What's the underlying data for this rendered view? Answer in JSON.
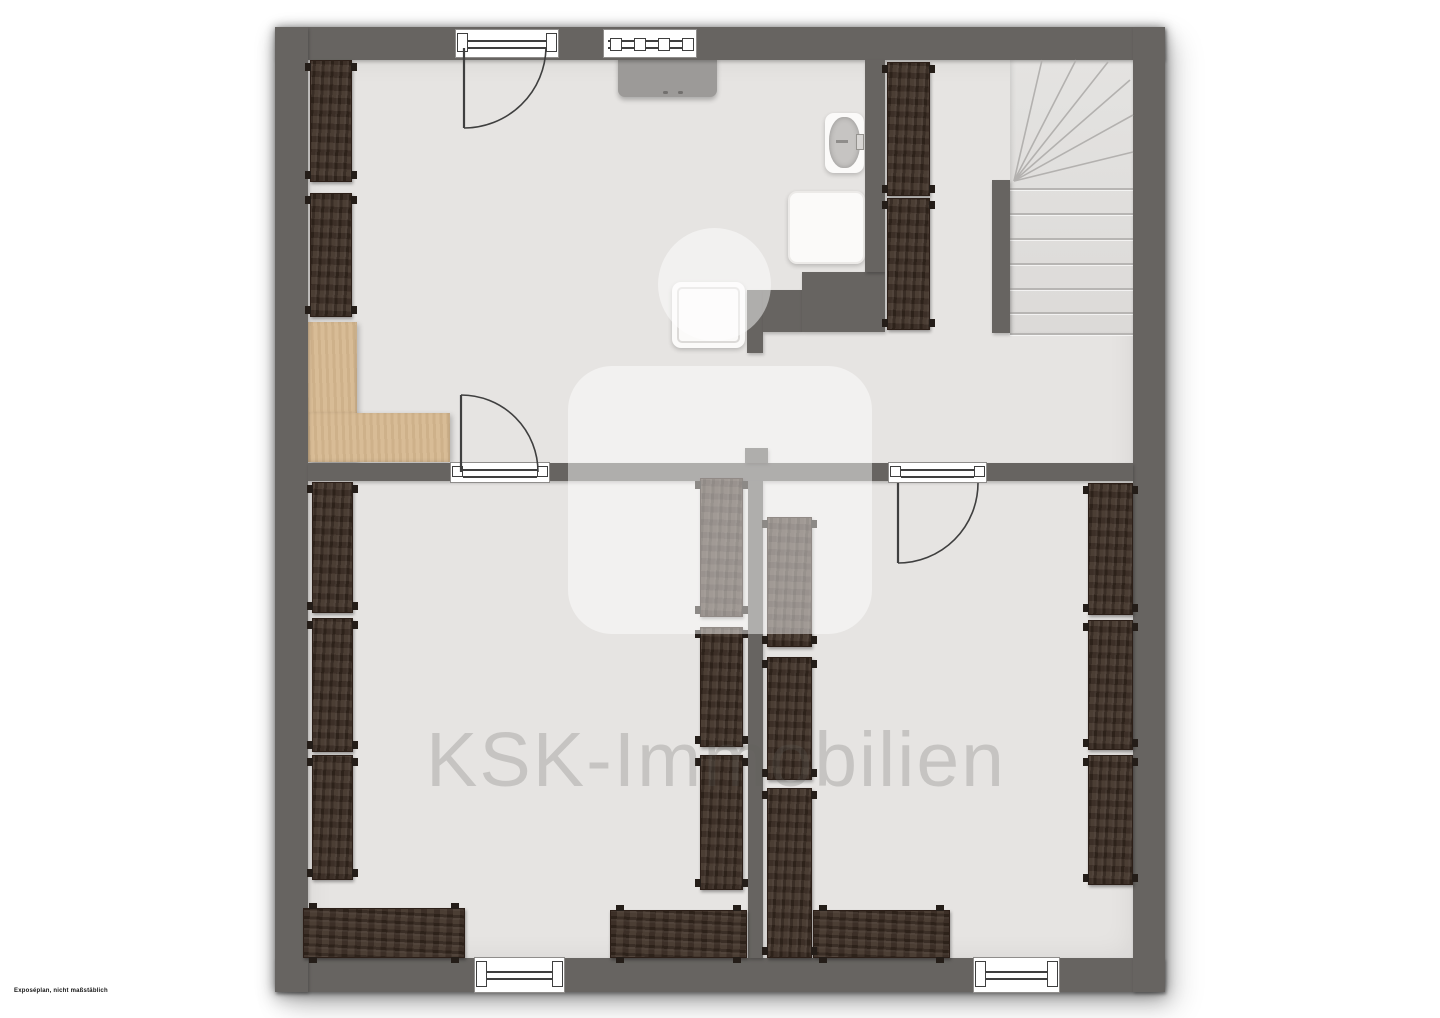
{
  "watermark": {
    "text": "KSK-Immobilien",
    "logo": "sparkasse-emblem"
  },
  "disclaimer": "Exposéplan, nicht maßstäblich",
  "colors": {
    "wall": "#676461",
    "floor": "#e6e4e2",
    "wood": "#3a2b21",
    "tan": "#d6b890",
    "fixture_white": "#fbfaf9",
    "counter": "#9c9a98",
    "stair_floor": "#e3e2e0",
    "arc_stroke": "#3f3f3f",
    "watermark_shape": "rgba(255,255,255,0.48)",
    "watermark_text": "rgba(98,96,94,0.24)"
  },
  "plan": {
    "building": {
      "x": 275,
      "y": 27,
      "w": 890,
      "h": 965
    },
    "floor": {
      "x": 308,
      "y": 60,
      "w": 825,
      "h": 898
    },
    "walls": [
      {
        "name": "wall-top",
        "x": 275,
        "y": 27,
        "w": 890,
        "h": 33
      },
      {
        "name": "wall-bottom",
        "x": 275,
        "y": 958,
        "w": 890,
        "h": 34
      },
      {
        "name": "wall-left",
        "x": 275,
        "y": 27,
        "w": 33,
        "h": 965
      },
      {
        "name": "wall-right",
        "x": 1133,
        "y": 27,
        "w": 32,
        "h": 965
      },
      {
        "name": "wall-middle",
        "x": 308,
        "y": 463,
        "w": 825,
        "h": 18
      },
      {
        "name": "wall-divider-lower",
        "x": 748,
        "y": 481,
        "w": 15,
        "h": 477
      },
      {
        "name": "wall-stub",
        "x": 745,
        "y": 448,
        "w": 23,
        "h": 15
      },
      {
        "name": "wall-bath-left",
        "x": 747,
        "y": 290,
        "w": 16,
        "h": 63
      },
      {
        "name": "wall-bath-mid",
        "x": 763,
        "y": 290,
        "w": 39,
        "h": 42
      },
      {
        "name": "wall-bath-top",
        "x": 802,
        "y": 272,
        "w": 83,
        "h": 60
      },
      {
        "name": "wall-upper-divider",
        "x": 865,
        "y": 60,
        "w": 20,
        "h": 212
      },
      {
        "name": "stair-newel-wall",
        "x": 992,
        "y": 180,
        "w": 18,
        "h": 153
      }
    ],
    "windows": [
      {
        "name": "window-top-left",
        "x": 455,
        "y": 29,
        "w": 104,
        "h": 29,
        "style": "double"
      },
      {
        "name": "window-top-mid",
        "x": 603,
        "y": 29,
        "w": 94,
        "h": 29,
        "style": "panes"
      },
      {
        "name": "window-bottom-left",
        "x": 474,
        "y": 957,
        "w": 91,
        "h": 36,
        "style": "double"
      },
      {
        "name": "window-bottom-right",
        "x": 973,
        "y": 957,
        "w": 87,
        "h": 36,
        "style": "double"
      }
    ],
    "door_sills": [
      {
        "name": "door-sill-left",
        "x": 450,
        "y": 462,
        "w": 100,
        "h": 21,
        "style": "double"
      },
      {
        "name": "door-sill-right",
        "x": 888,
        "y": 462,
        "w": 99,
        "h": 21,
        "style": "double"
      }
    ],
    "doors": [
      {
        "name": "door-top-entry",
        "leaf": "M464,48 L464,128",
        "arc": "M464,128 A82,82 0 0 0 546,48"
      },
      {
        "name": "door-lower-left-room",
        "leaf": "M461,472 L461,395",
        "arc": "M461,395 A77,77 0 0 1 538,472"
      },
      {
        "name": "door-lower-right-room",
        "leaf": "M898,483 L898,563",
        "arc": "M898,563 A80,80 0 0 0 978,483"
      }
    ],
    "wardrobes": [
      {
        "name": "wardrobe-upper-left-1",
        "x": 310,
        "y": 60,
        "w": 42,
        "h": 122,
        "orient": "v"
      },
      {
        "name": "wardrobe-upper-left-2",
        "x": 310,
        "y": 193,
        "w": 42,
        "h": 124,
        "orient": "v"
      },
      {
        "name": "wardrobe-hall-1",
        "x": 887,
        "y": 62,
        "w": 43,
        "h": 134,
        "orient": "v"
      },
      {
        "name": "wardrobe-hall-2",
        "x": 887,
        "y": 198,
        "w": 43,
        "h": 132,
        "orient": "v"
      },
      {
        "name": "wardrobe-lower-left-1",
        "x": 312,
        "y": 482,
        "w": 41,
        "h": 131,
        "orient": "v"
      },
      {
        "name": "wardrobe-lower-left-2",
        "x": 312,
        "y": 618,
        "w": 41,
        "h": 134,
        "orient": "v"
      },
      {
        "name": "wardrobe-lower-left-3",
        "x": 312,
        "y": 755,
        "w": 41,
        "h": 125,
        "orient": "v"
      },
      {
        "name": "wardrobe-center-left-1",
        "x": 700,
        "y": 478,
        "w": 43,
        "h": 139,
        "orient": "v"
      },
      {
        "name": "wardrobe-center-left-2",
        "x": 700,
        "y": 627,
        "w": 43,
        "h": 120,
        "orient": "v"
      },
      {
        "name": "wardrobe-center-left-3",
        "x": 700,
        "y": 755,
        "w": 43,
        "h": 135,
        "orient": "v"
      },
      {
        "name": "wardrobe-center-right-1",
        "x": 767,
        "y": 517,
        "w": 45,
        "h": 130,
        "orient": "v"
      },
      {
        "name": "wardrobe-center-right-2",
        "x": 767,
        "y": 657,
        "w": 45,
        "h": 123,
        "orient": "v"
      },
      {
        "name": "wardrobe-center-right-3",
        "x": 767,
        "y": 788,
        "w": 45,
        "h": 170,
        "orient": "v"
      },
      {
        "name": "wardrobe-lower-right-1",
        "x": 1088,
        "y": 483,
        "w": 45,
        "h": 132,
        "orient": "v"
      },
      {
        "name": "wardrobe-lower-right-2",
        "x": 1088,
        "y": 620,
        "w": 45,
        "h": 130,
        "orient": "v"
      },
      {
        "name": "wardrobe-lower-right-3",
        "x": 1088,
        "y": 755,
        "w": 45,
        "h": 130,
        "orient": "v"
      },
      {
        "name": "wardrobe-bottom-left",
        "x": 303,
        "y": 908,
        "w": 162,
        "h": 50,
        "orient": "h"
      },
      {
        "name": "wardrobe-bottom-mid",
        "x": 610,
        "y": 910,
        "w": 137,
        "h": 48,
        "orient": "h"
      },
      {
        "name": "wardrobe-bottom-right",
        "x": 813,
        "y": 910,
        "w": 137,
        "h": 48,
        "orient": "h"
      }
    ],
    "tan_area": [
      {
        "name": "chimney-block-vertical",
        "x": 308,
        "y": 322,
        "w": 49,
        "h": 140
      },
      {
        "name": "chimney-block-horizontal",
        "x": 308,
        "y": 413,
        "w": 142,
        "h": 49
      }
    ],
    "fixtures": {
      "counter": {
        "x": 618,
        "y": 57,
        "w": 99,
        "h": 40
      },
      "counter_dots": [
        {
          "x": 663,
          "y": 91,
          "w": 5,
          "h": 3
        },
        {
          "x": 678,
          "y": 91,
          "w": 5,
          "h": 3
        }
      ],
      "basin": {
        "x": 825,
        "y": 113,
        "w": 39,
        "h": 60
      },
      "basin_bowl": {
        "x": 829,
        "y": 117,
        "w": 31,
        "h": 51
      },
      "basin_tap": {
        "x": 856,
        "y": 134,
        "w": 8,
        "h": 16
      },
      "basin_spout": {
        "x": 836,
        "y": 140,
        "w": 12,
        "h": 3
      },
      "shower_unit": {
        "x": 788,
        "y": 191,
        "w": 77,
        "h": 73
      },
      "shower_tray": {
        "x": 672,
        "y": 282,
        "w": 73,
        "h": 66
      }
    },
    "stairs": {
      "region": {
        "x": 1010,
        "y": 60,
        "w": 123,
        "h": 275
      },
      "treads_y": [
        188,
        213,
        238,
        263,
        288,
        312,
        333
      ],
      "fan_focus": [
        1014,
        181
      ],
      "fan_ends": [
        [
          1042,
          60
        ],
        [
          1076,
          60
        ],
        [
          1108,
          62
        ],
        [
          1130,
          80
        ],
        [
          1133,
          115
        ],
        [
          1133,
          152
        ]
      ]
    },
    "watermark_shapes": [
      {
        "name": "watermark-logo-dot",
        "type": "circle",
        "x": 658,
        "y": 228,
        "w": 113,
        "h": 113
      },
      {
        "name": "watermark-logo-body",
        "type": "rrect",
        "x": 568,
        "y": 366,
        "w": 304,
        "h": 268,
        "r": 44
      }
    ]
  }
}
